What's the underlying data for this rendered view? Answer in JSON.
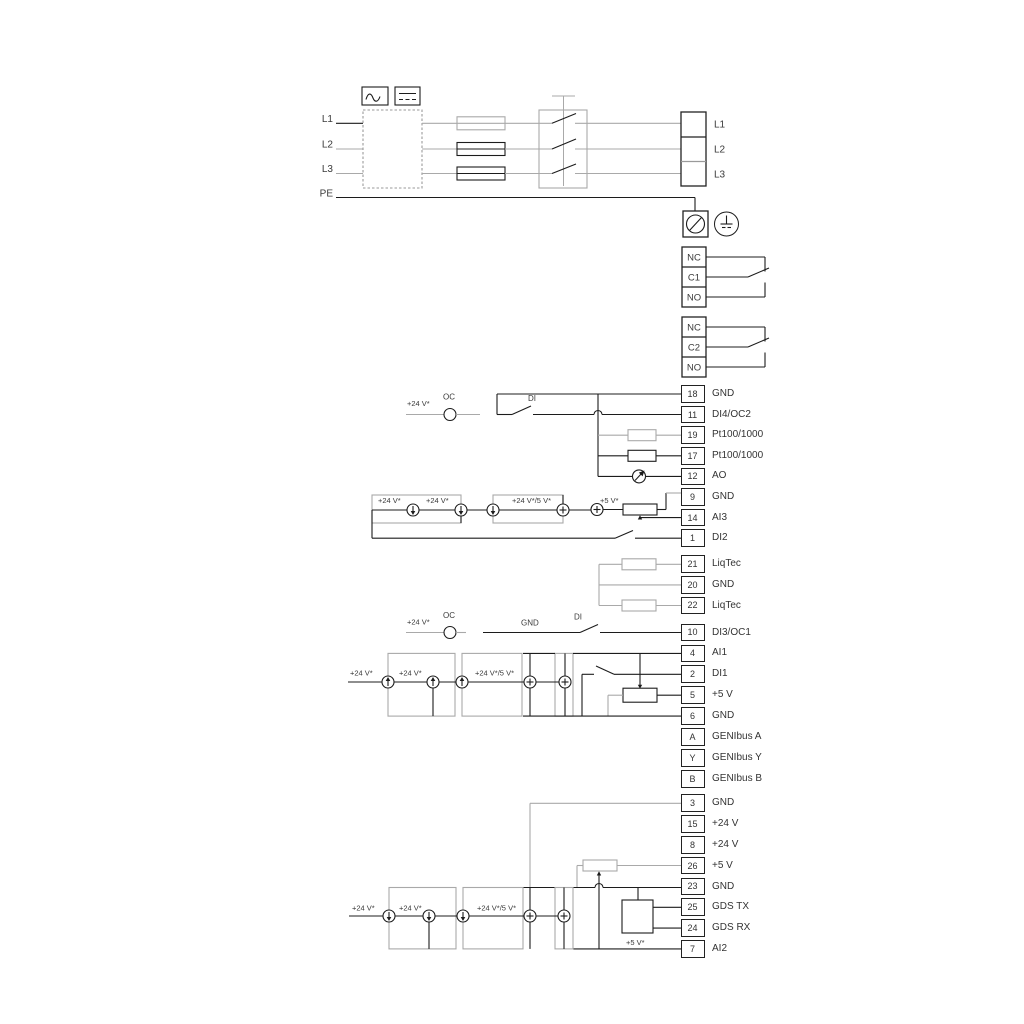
{
  "power_in": [
    "L1",
    "L2",
    "L3",
    "PE"
  ],
  "power_out": [
    "L1",
    "L2",
    "L3"
  ],
  "relay1": [
    "NC",
    "C1",
    "NO"
  ],
  "relay2": [
    "NC",
    "C2",
    "NO"
  ],
  "ann": {
    "plus24": "+24 V*",
    "plus24_5": "+24 V*/5 V*",
    "plus5": "+5 V*",
    "oc": "OC",
    "di": "DI",
    "gnd": "GND"
  },
  "colors": {
    "line": "#1c1c1c",
    "option": "#a9a9a9"
  },
  "strips": {
    "io1": [
      {
        "n": "18",
        "l": "GND"
      },
      {
        "n": "11",
        "l": "DI4/OC2"
      },
      {
        "n": "19",
        "l": "Pt100/1000"
      },
      {
        "n": "17",
        "l": "Pt100/1000"
      },
      {
        "n": "12",
        "l": "AO"
      },
      {
        "n": "9",
        "l": "GND"
      },
      {
        "n": "14",
        "l": "AI3"
      },
      {
        "n": "1",
        "l": "DI2"
      }
    ],
    "liqtec": [
      {
        "n": "21",
        "l": "LiqTec"
      },
      {
        "n": "20",
        "l": "GND"
      },
      {
        "n": "22",
        "l": "LiqTec"
      }
    ],
    "io2": [
      {
        "n": "10",
        "l": "DI3/OC1"
      },
      {
        "n": "4",
        "l": "AI1"
      },
      {
        "n": "2",
        "l": "DI1"
      },
      {
        "n": "5",
        "l": "+5 V"
      },
      {
        "n": "6",
        "l": "GND"
      },
      {
        "n": "A",
        "l": "GENIbus A"
      },
      {
        "n": "Y",
        "l": "GENIbus Y"
      },
      {
        "n": "B",
        "l": "GENIbus B"
      }
    ],
    "io3": [
      {
        "n": "3",
        "l": "GND"
      },
      {
        "n": "15",
        "l": "+24 V"
      },
      {
        "n": "8",
        "l": "+24 V"
      },
      {
        "n": "26",
        "l": "+5 V"
      },
      {
        "n": "23",
        "l": "GND"
      },
      {
        "n": "25",
        "l": "GDS TX"
      },
      {
        "n": "24",
        "l": "GDS RX"
      },
      {
        "n": "7",
        "l": "AI2"
      }
    ]
  }
}
